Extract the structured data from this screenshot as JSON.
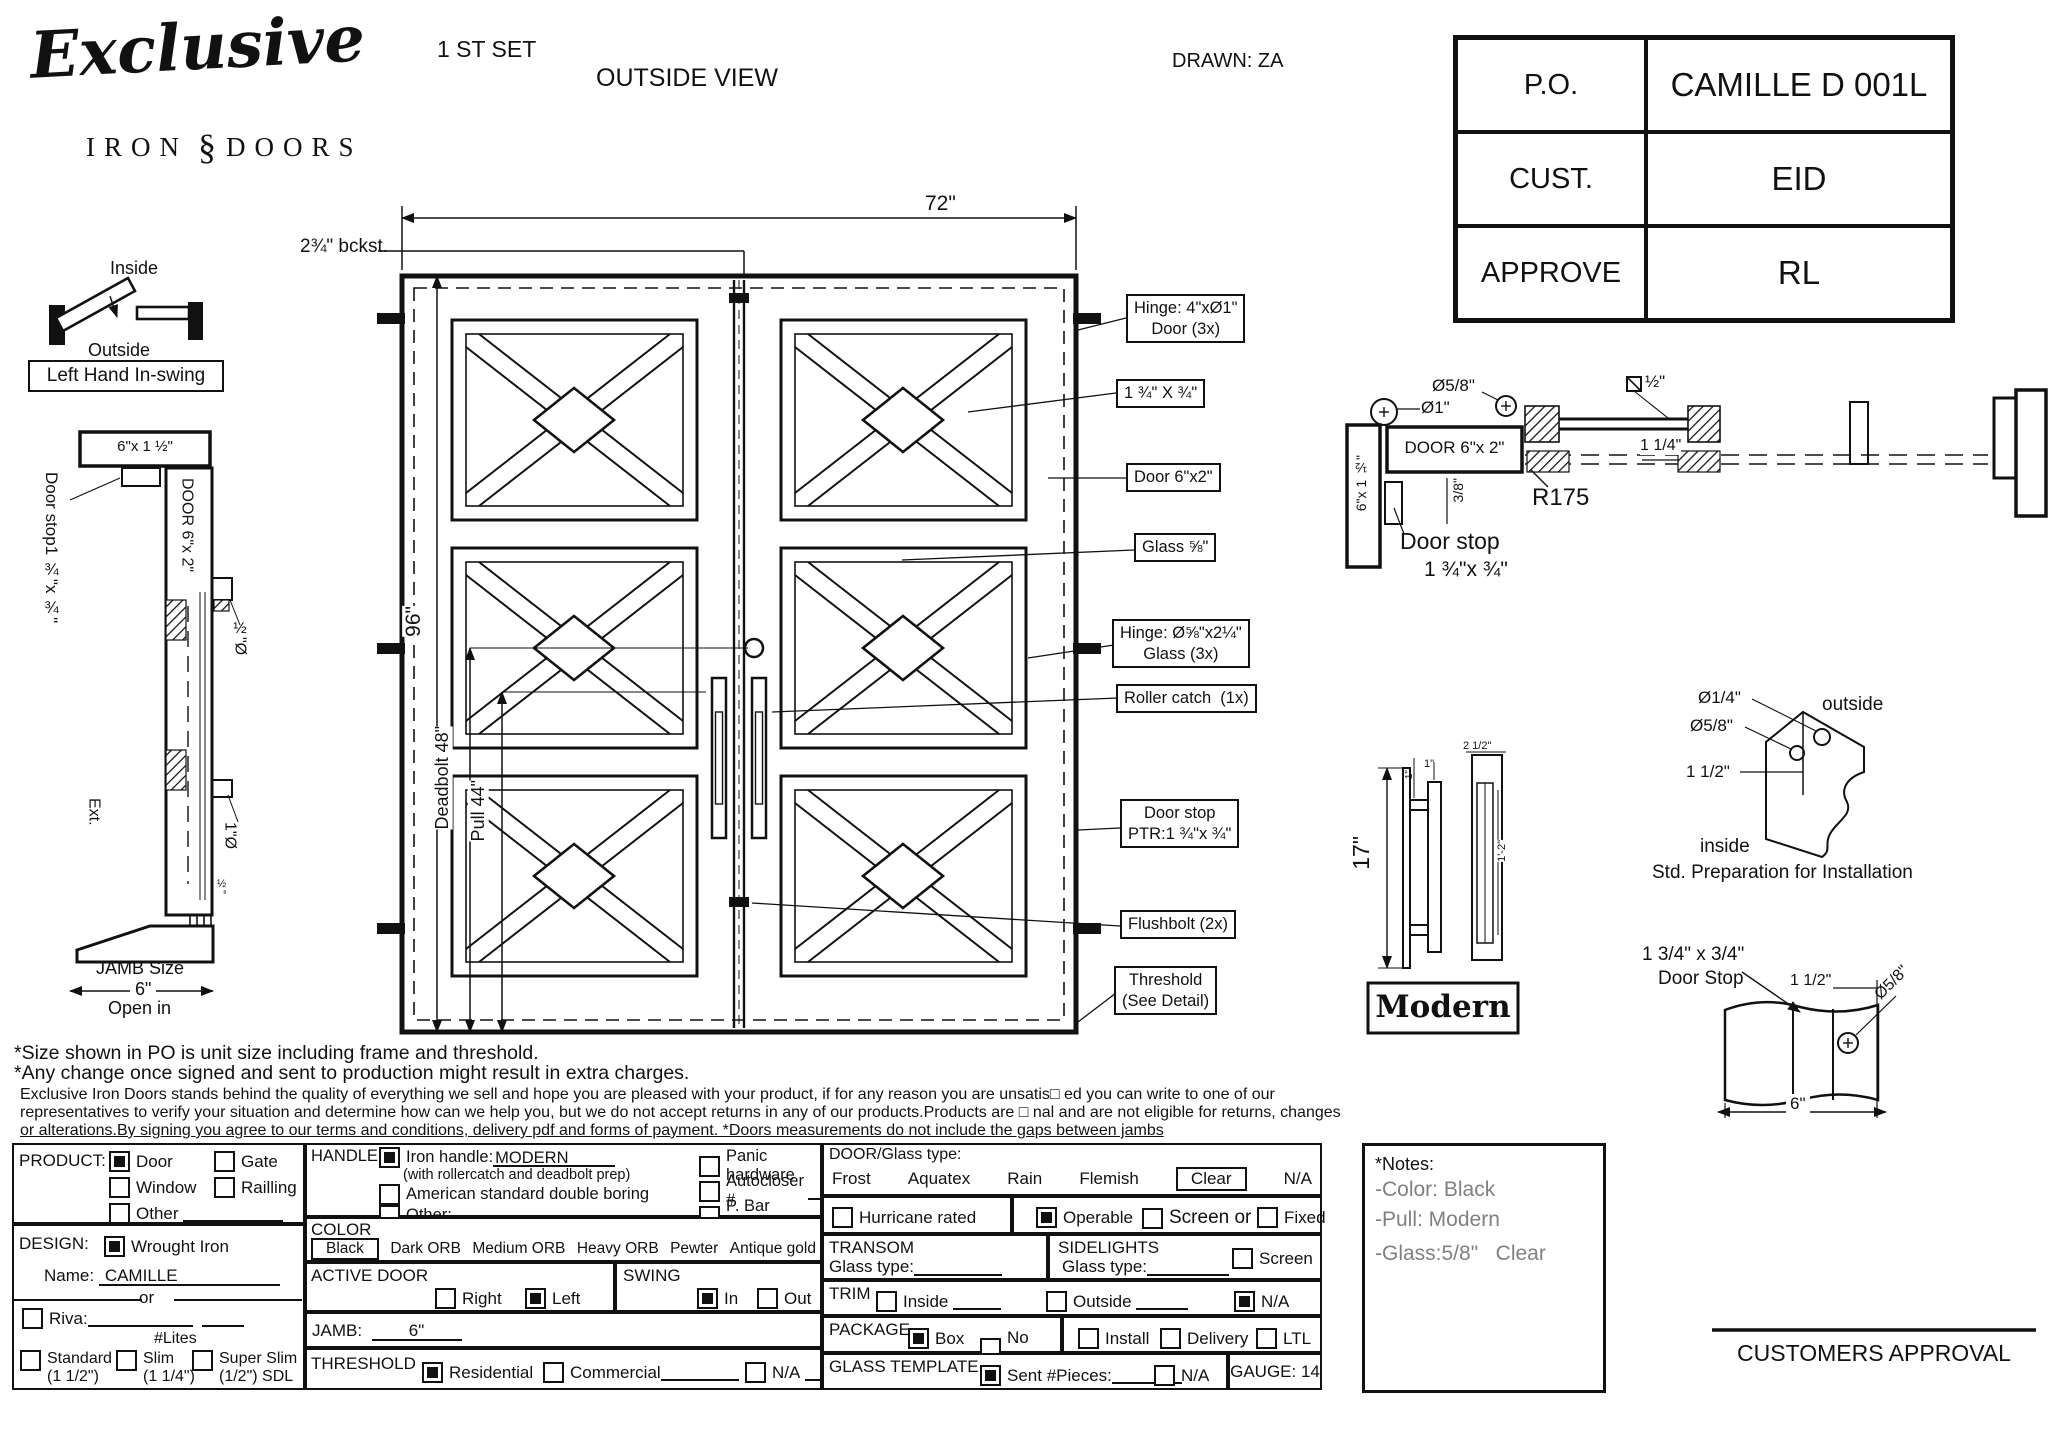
{
  "header": {
    "logo_script": "Exclusive",
    "logo_sub_left": "IRON",
    "logo_sub_mid": "§",
    "logo_sub_right": "DOORS",
    "set_label": "1 ST SET",
    "view_label": "OUTSIDE VIEW",
    "drawn": "DRAWN: ZA"
  },
  "info_table": {
    "rows": [
      {
        "label": "P.O.",
        "value": "CAMILLE D 001L"
      },
      {
        "label": "CUST.",
        "value": "EID"
      },
      {
        "label": "APPROVE",
        "value": "RL"
      }
    ]
  },
  "swing": {
    "inside": "Inside",
    "outside": "Outside",
    "boxed": "Left Hand In-swing"
  },
  "left_section": {
    "head_size": "6\"x 1 ½\"",
    "door_label": "DOOR 6\"x 2\"",
    "door_stop_l1": "Door stop",
    "door_stop_l2": "1 ¾\"x ¾\"",
    "half_dia": "½\"Ø",
    "one_dia": "1\"Ø",
    "ext": "Ext.",
    "half_tick": "½\"",
    "jamb_size_l1": "JAMB Size",
    "jamb_size_val": "6\"",
    "open_in": "Open in"
  },
  "elevation": {
    "width_dim": "72\"",
    "height_dim": "96\"",
    "backset": "2¾\" bckst.",
    "deadbolt_dim": "Deadbolt 48\"",
    "pull_dim": "Pull 44\"",
    "callouts": [
      {
        "l1": "Hinge: 4\"xØ1\"",
        "l2": "Door (3x)"
      },
      {
        "l1": "1 ¾\" X ¾\""
      },
      {
        "l1": "Door 6\"x2\""
      },
      {
        "l1": "Glass ⅝\""
      },
      {
        "l1": "Hinge: Ø⅝\"x2¼\"",
        "l2": "Glass (3x)"
      },
      {
        "l1": "Roller catch  (1x)"
      },
      {
        "l1": "Door stop",
        "l2": "PTR:1 ¾\"x ¾\""
      },
      {
        "l1": "Flushbolt (2x)"
      },
      {
        "l1": "Threshold",
        "l2": "(See Detail)"
      }
    ]
  },
  "head_detail": {
    "dia1": "Ø1\"",
    "dia58": "Ø5/8\"",
    "sq_half": "½\"",
    "door_label": "DOOR 6\"x 2\"",
    "jamb_label": "6\"x 1 ½\"",
    "r175": "R175",
    "dim114": "1 1/4\"",
    "dim38": "3/8\"",
    "stop_l1": "Door stop",
    "stop_l2": "1 ¾\"x ¾\""
  },
  "handle_detail": {
    "height": "17\"",
    "one_a": "1\"",
    "one_b": "1\"",
    "width_top": "2 1/2\"",
    "length": "1'-2\"",
    "name": "Modern"
  },
  "install_detail": {
    "dia14": "Ø1/4\"",
    "dia58": "Ø5/8\"",
    "offset": "1 1/2\"",
    "outside": "outside",
    "inside": "inside",
    "caption": "Std. Preparation for Installation"
  },
  "stop_detail": {
    "title_l1": "1 3/4\" x 3/4\"",
    "title_l2": "Door Stop",
    "dim_half": "1 1/2\"",
    "dia": "Ø5/8\"",
    "width": "6\""
  },
  "notes": {
    "line1": "*Size shown in PO is unit size including frame and threshold.",
    "line2": "*Any change once signed and sent to production might result in extra charges.",
    "para1": "Exclusive Iron Doors stands behind the quality of everything we sell and hope you are pleased with your product, if for any reason you are unsatis□ ed you can write to one of our",
    "para2": "representatives to verify your situation and determine how can we help you, but we do not accept returns in any of our products.Products are □ nal and are not eligible for returns, changes",
    "para3": "or alterations.By signing you agree to our terms and conditions, delivery pdf and forms of payment. *Doors measurements do not include the gaps between jambs"
  },
  "form": {
    "product": {
      "title": "PRODUCT:",
      "options": [
        {
          "label": "Door",
          "on": true
        },
        {
          "label": "Gate",
          "on": false
        },
        {
          "label": "Window",
          "on": false
        },
        {
          "label": "Railling",
          "on": false
        },
        {
          "label": "Other",
          "on": false
        }
      ]
    },
    "design": {
      "title": "DESIGN:",
      "wrought": {
        "label": "Wrought Iron",
        "on": true
      },
      "name_label": "Name:",
      "name_value": "CAMILLE",
      "or_label": "or",
      "riva": {
        "label": "Riva:",
        "on": false
      },
      "lites_label": "#Lites",
      "types": [
        {
          "label": "Standard",
          "sub": "(1 1/2\")",
          "on": false
        },
        {
          "label": "Slim",
          "sub": "(1 1/4\")",
          "on": false
        },
        {
          "label": "Super Slim",
          "sub": "(1/2\") SDL",
          "on": false
        }
      ]
    },
    "handle": {
      "title": "HANDLE",
      "iron": {
        "label": "Iron handle:",
        "value": "MODERN",
        "note": "(with rollercatch and deadbolt prep)",
        "on": true
      },
      "american": {
        "label": "American standard double boring",
        "on": false
      },
      "other": {
        "label": "Other:",
        "on": false
      },
      "panic": {
        "label": "Panic hardware",
        "on": false
      },
      "autocloser": {
        "label": "Autocloser #",
        "on": false
      },
      "pbar": {
        "label": "P. Bar #",
        "on": false
      }
    },
    "color": {
      "title": "COLOR",
      "options": [
        {
          "label": "Black",
          "on": true
        },
        {
          "label": "Dark ORB",
          "on": false
        },
        {
          "label": "Medium ORB",
          "on": false
        },
        {
          "label": "Heavy ORB",
          "on": false
        },
        {
          "label": "Pewter",
          "on": false
        },
        {
          "label": "Antique gold",
          "on": false
        }
      ]
    },
    "active_door": {
      "title": "ACTIVE DOOR",
      "right": {
        "label": "Right",
        "on": false
      },
      "left": {
        "label": "Left",
        "on": true
      }
    },
    "swing_sec": {
      "title": "SWING",
      "in": {
        "label": "In",
        "on": true
      },
      "out": {
        "label": "Out",
        "on": false
      }
    },
    "jamb": {
      "title": "JAMB:",
      "value": "6\""
    },
    "threshold": {
      "title": "THRESHOLD",
      "options": [
        {
          "label": "Residential",
          "on": true
        },
        {
          "label": "Commercial",
          "on": false
        },
        {
          "label": "N/A",
          "on": false
        }
      ]
    },
    "door_glass": {
      "title": "DOOR/Glass type:",
      "options": [
        "Frost",
        "Aquatex",
        "Rain",
        "Flemish",
        "Clear",
        "N/A"
      ],
      "selected": "Clear"
    },
    "hurricane": {
      "label": "Hurricane rated",
      "on": false
    },
    "operable": {
      "options": [
        {
          "label": "Operable",
          "on": true
        },
        {
          "label": "Screen or",
          "on": false
        },
        {
          "label": "Fixed",
          "on": false
        }
      ]
    },
    "transom": {
      "title": "TRANSOM",
      "glass_label": "Glass type:"
    },
    "sidelights": {
      "title": "SIDELIGHTS",
      "glass_label": "Glass type:",
      "screen": {
        "label": "Screen",
        "on": false
      }
    },
    "trim": {
      "title": "TRIM",
      "options": [
        {
          "label": "Inside",
          "on": false
        },
        {
          "label": "Outside",
          "on": false
        },
        {
          "label": "N/A",
          "on": true
        }
      ]
    },
    "package": {
      "title": "PACKAGE",
      "options": [
        {
          "label": "Box",
          "on": true
        },
        {
          "label": "No box",
          "on": false
        }
      ],
      "ship": [
        {
          "label": "Install",
          "on": false
        },
        {
          "label": "Delivery",
          "on": false
        },
        {
          "label": "LTL",
          "on": false
        }
      ]
    },
    "glass_template": {
      "title": "GLASS TEMPLATE",
      "sent": {
        "label": "Sent #Pieces:",
        "on": true
      },
      "na": {
        "label": "N/A",
        "on": false
      }
    },
    "gauge": "GAUGE: 14"
  },
  "notes_box": {
    "title": "*Notes:",
    "lines": [
      "-Color: Black",
      "-Pull: Modern",
      "-Glass:5/8\"   Clear"
    ]
  },
  "approval": "CUSTOMERS APPROVAL"
}
